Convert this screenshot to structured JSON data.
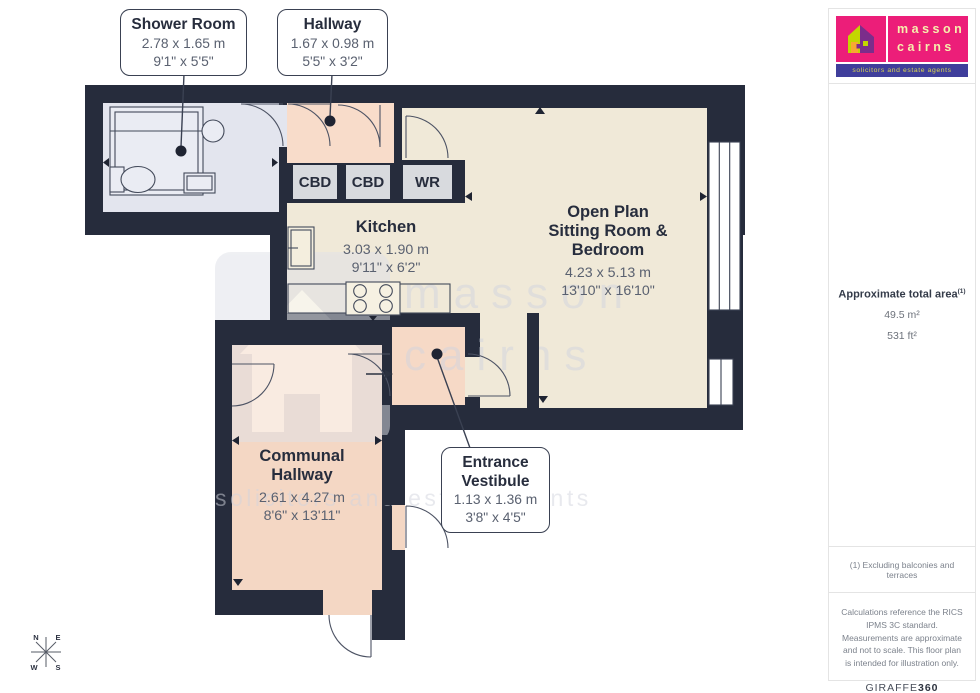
{
  "plan": {
    "callouts": {
      "shower_room": {
        "title": "Shower Room",
        "dims_m": "2.78 x 1.65 m",
        "dims_ft": "9'1\" x 5'5\""
      },
      "hallway": {
        "title": "Hallway",
        "dims_m": "1.67 x 0.98 m",
        "dims_ft": "5'5\" x 3'2\""
      },
      "entrance_vestibule": {
        "title_line1": "Entrance",
        "title_line2": "Vestibule",
        "dims_m": "1.13 x 1.36 m",
        "dims_ft": "3'8\" x 4'5\""
      }
    },
    "room_labels": {
      "kitchen": {
        "title": "Kitchen",
        "dims_m": "3.03 x 1.90 m",
        "dims_ft": "9'11\" x 6'2\""
      },
      "open_plan": {
        "title_line1": "Open Plan",
        "title_line2": "Sitting Room &",
        "title_line3": "Bedroom",
        "dims_m": "4.23 x 5.13 m",
        "dims_ft": "13'10\" x 16'10\""
      },
      "communal_hallway": {
        "title_line1": "Communal",
        "title_line2": "Hallway",
        "dims_m": "2.61 x 4.27 m",
        "dims_ft": "8'6\" x 13'11\""
      }
    },
    "closets": [
      "CBD",
      "CBD",
      "WR"
    ],
    "compass": {
      "n": "N",
      "e": "E",
      "s": "S",
      "w": "W"
    },
    "colors": {
      "wall": "#262c3c",
      "shower_floor": "#e3e5ee",
      "hallway_floor": "#f8dcca",
      "communal_floor": "#f4d7c4",
      "vestibule_floor": "#f6d9c6",
      "living_floor": "#f0e9d8",
      "closet_fill": "#d8dade"
    }
  },
  "watermark": {
    "line1": "masson",
    "line2": "cairns",
    "line3": "solicitors and estate agents"
  },
  "sidebar": {
    "logo": {
      "name_line1": "masson",
      "name_line2": "cairns",
      "tagline": "solicitors and estate agents",
      "colors": {
        "magenta": "#ec1e79",
        "blue": "#3f3e9b",
        "lime": "#c3d600",
        "purple": "#7b2d8b",
        "orange": "#f7a832"
      }
    },
    "area": {
      "label": "Approximate total area",
      "footnote_marker": "(1)",
      "metric": "49.5 m²",
      "imperial": "531 ft²"
    },
    "footnote": "(1) Excluding balconies and terraces",
    "disclaimer": "Calculations reference the RICS IPMS 3C standard. Measurements are approximate and not to scale. This floor plan is intended for illustration only.",
    "brand": {
      "name": "GIRAFFE",
      "suffix": "360"
    }
  }
}
